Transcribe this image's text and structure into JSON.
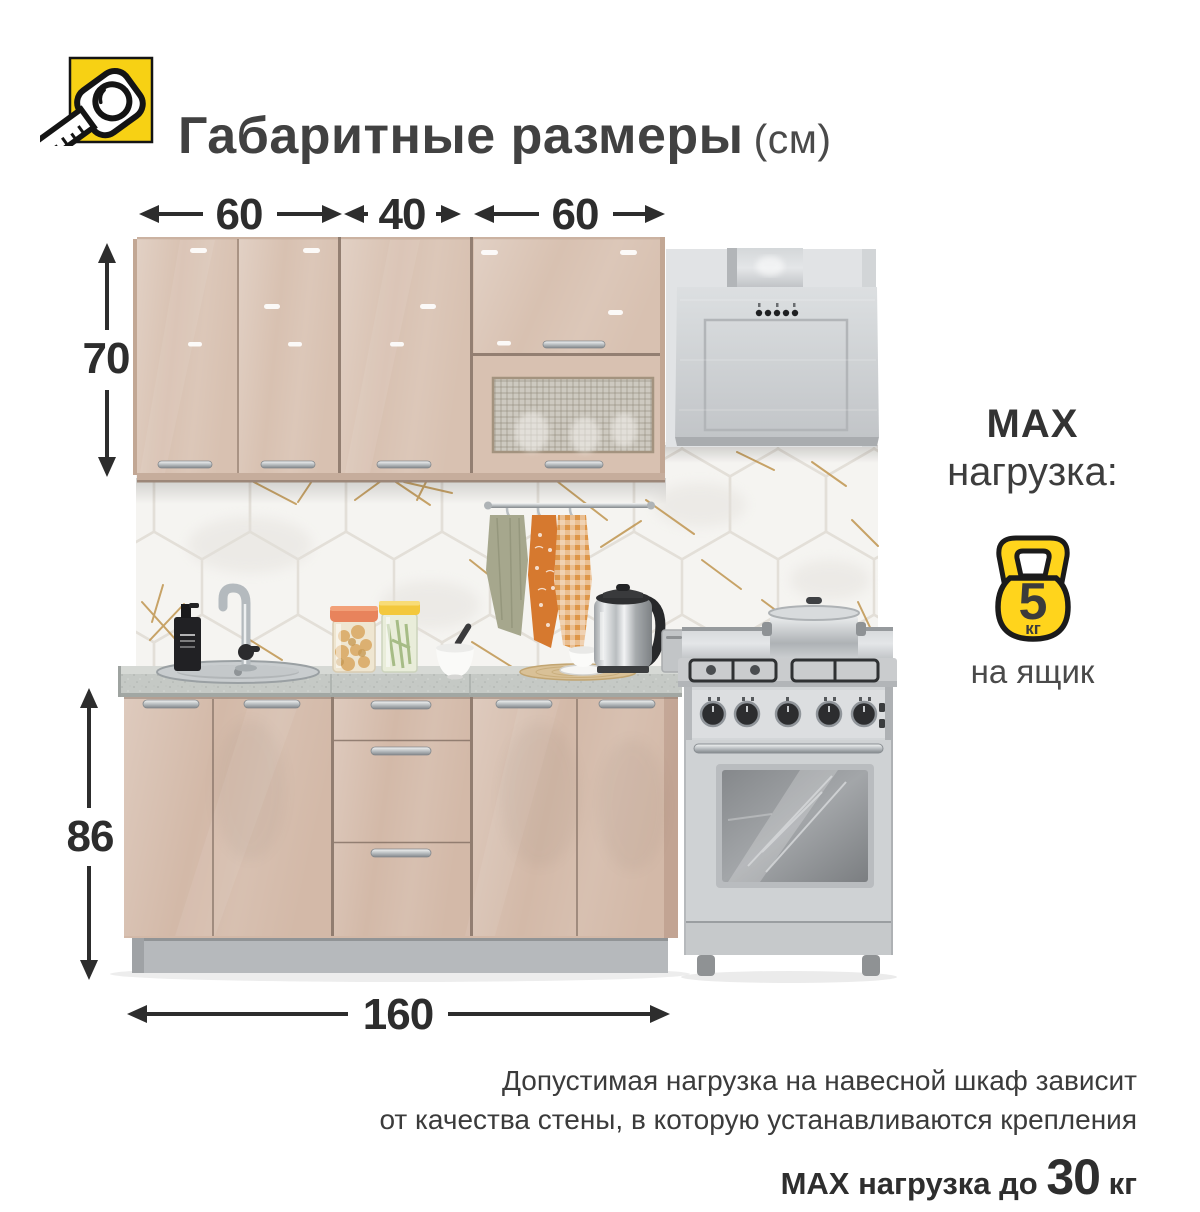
{
  "header": {
    "icon": "tape-measure-icon",
    "title": "Габаритные размеры",
    "unit": "(см)"
  },
  "dimensions": {
    "top_widths": [
      "60",
      "40",
      "60"
    ],
    "upper_cabinet_height": "70",
    "base_cabinet_height": "86",
    "total_width": "160"
  },
  "max_load": {
    "title": "MAX",
    "subtitle": "нагрузка:",
    "icon": "kettlebell-icon",
    "value": "5",
    "unit": "кг",
    "per": "на ящик"
  },
  "footnote": {
    "line1": "Допустимая нагрузка на навесной шкаф зависит",
    "line2": "от качества стены, в которую устанавливаются крепления",
    "line3_prefix": "MAX нагрузка до ",
    "line3_value": "30",
    "line3_unit": " кг"
  },
  "colors": {
    "accent_yellow": "#F7D114",
    "kettlebell_yellow": "#FFD41C",
    "text_dark": "#2d2d2d",
    "cabinet_beige": "#d7c0b0",
    "steel_gray": "#ced1d3",
    "countertop_gray": "#c6cac6",
    "plinth_gray": "#b6b9bc",
    "tile_gold": "#c09550"
  }
}
